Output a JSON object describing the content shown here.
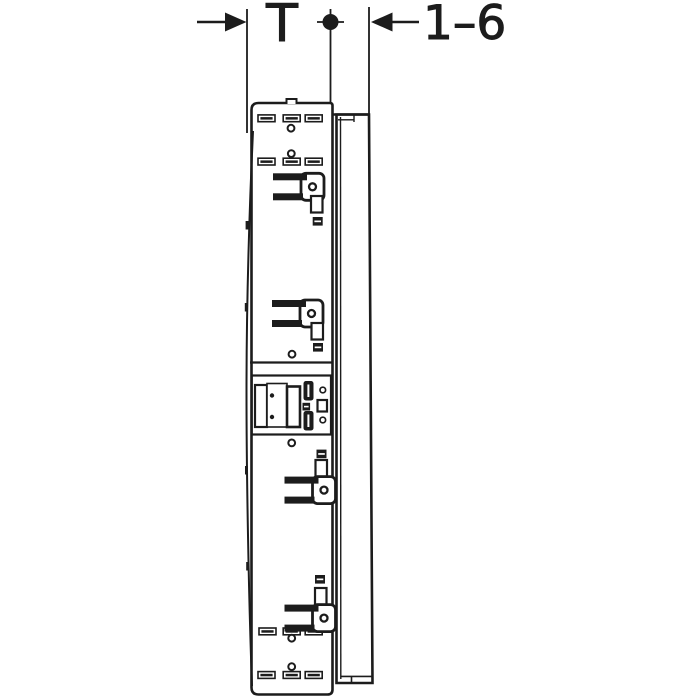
{
  "page": {
    "background_color": "#ffffff",
    "ink_color": "#1c1c1c"
  },
  "drawing": {
    "kind": "technical side-section drawing",
    "subject": "mirror cabinet side profile with mounting slots, rail hooks and hinge mechanism",
    "dimensions": [
      {
        "id": "depth",
        "label": "T",
        "terminators": "outside arrow left, dot on centerline right"
      },
      {
        "id": "door-range",
        "label": "1–6",
        "terminators": "outside arrow pointing left at door outer face"
      }
    ],
    "labels": {
      "depth": "T",
      "door_range": "1–6"
    }
  }
}
